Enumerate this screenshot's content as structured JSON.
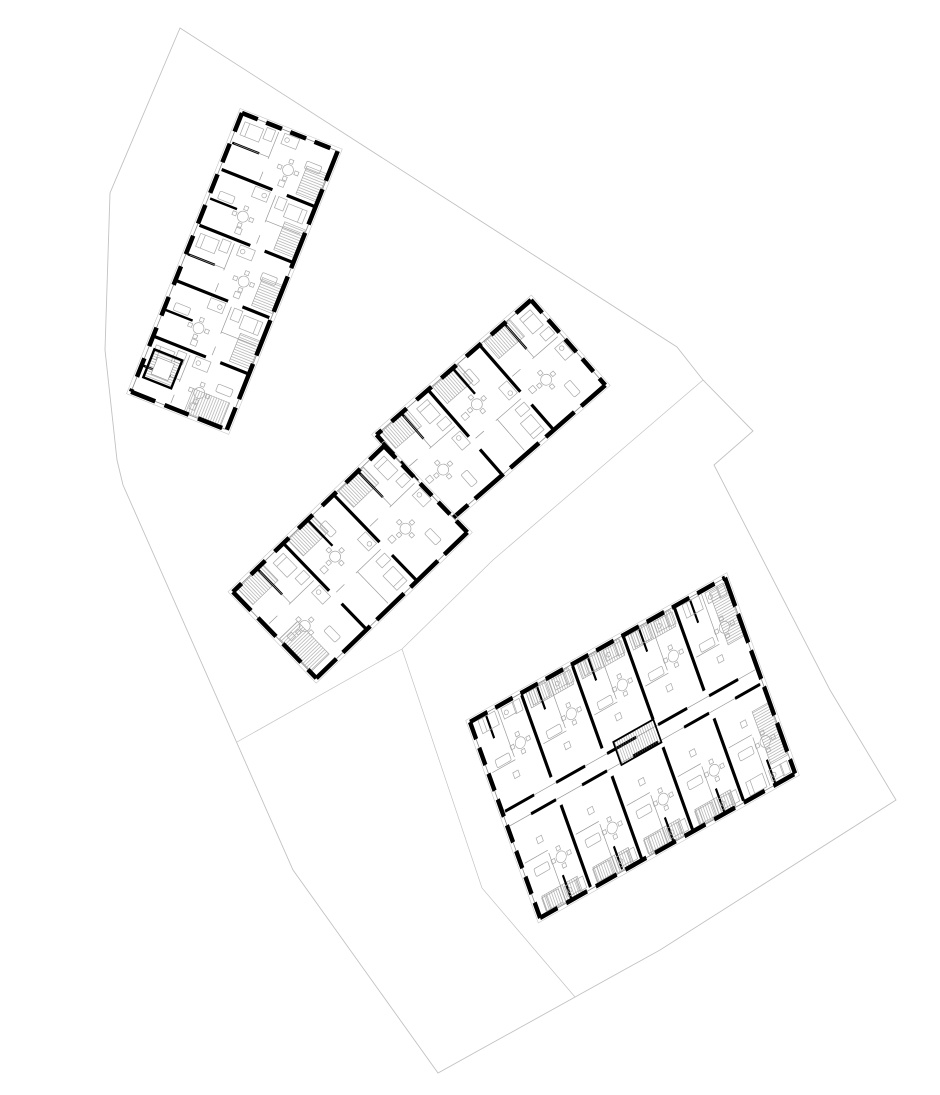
{
  "meta": {
    "title": "residential-site-floor-plan",
    "canvas": {
      "width": 940,
      "height": 1095,
      "background": "#ffffff"
    }
  },
  "colors": {
    "wall": "#000000",
    "window_line": "#8a8a8a",
    "thin": "#9a9a9a",
    "furniture": "#a8a8a8",
    "parcel": "#c2c2c2",
    "balcony_outline": "#9f9f9f",
    "hatch": "#7f7f7f",
    "floor": "#ffffff",
    "outer_thin": "#c7c7c7"
  },
  "parcel": {
    "outline": [
      [
        180,
        28
      ],
      [
        677,
        347
      ],
      [
        703,
        380
      ],
      [
        753,
        431
      ],
      [
        714,
        465
      ],
      [
        830,
        690
      ],
      [
        896,
        800
      ],
      [
        660,
        950
      ],
      [
        438,
        1073
      ],
      [
        293,
        870
      ],
      [
        123,
        485
      ],
      [
        117,
        460
      ],
      [
        105,
        350
      ],
      [
        110,
        193
      ]
    ],
    "divisions": [
      [
        [
          703,
          380
        ],
        [
          493,
          560
        ],
        [
          402,
          649
        ],
        [
          237,
          742
        ]
      ],
      [
        [
          402,
          649
        ],
        [
          482,
          888
        ],
        [
          575,
          997
        ]
      ]
    ]
  },
  "buildings": {
    "north_bar": {
      "type": "bar",
      "label": "north building",
      "x": 242,
      "y": 113,
      "rotation": 21.7,
      "width": 103,
      "length": 300,
      "units": 5,
      "balcony_side": "right",
      "end_balcony": true,
      "stair": true
    },
    "middle_bar_upper": {
      "type": "bar",
      "label": "middle building upper wing",
      "x": 531,
      "y": 300,
      "rotation": 48.9,
      "width": 113,
      "length": 205,
      "units": 3,
      "balcony_side": "left",
      "end_balcony": false,
      "stair": false
    },
    "middle_bar_lower": {
      "type": "bar",
      "label": "middle building lower wing",
      "x": 384,
      "y": 446,
      "rotation": 46,
      "width": 120,
      "length": 210,
      "units": 3,
      "balcony_side": "left",
      "end_balcony": true,
      "stair": false
    },
    "south_slab": {
      "type": "slab",
      "label": "south building",
      "x": 470,
      "y": 722,
      "rotation": -29.5,
      "skew": -9.8,
      "width": 205,
      "length": 293,
      "units_per_row": 5,
      "corridor": [
        95,
        110
      ]
    }
  }
}
